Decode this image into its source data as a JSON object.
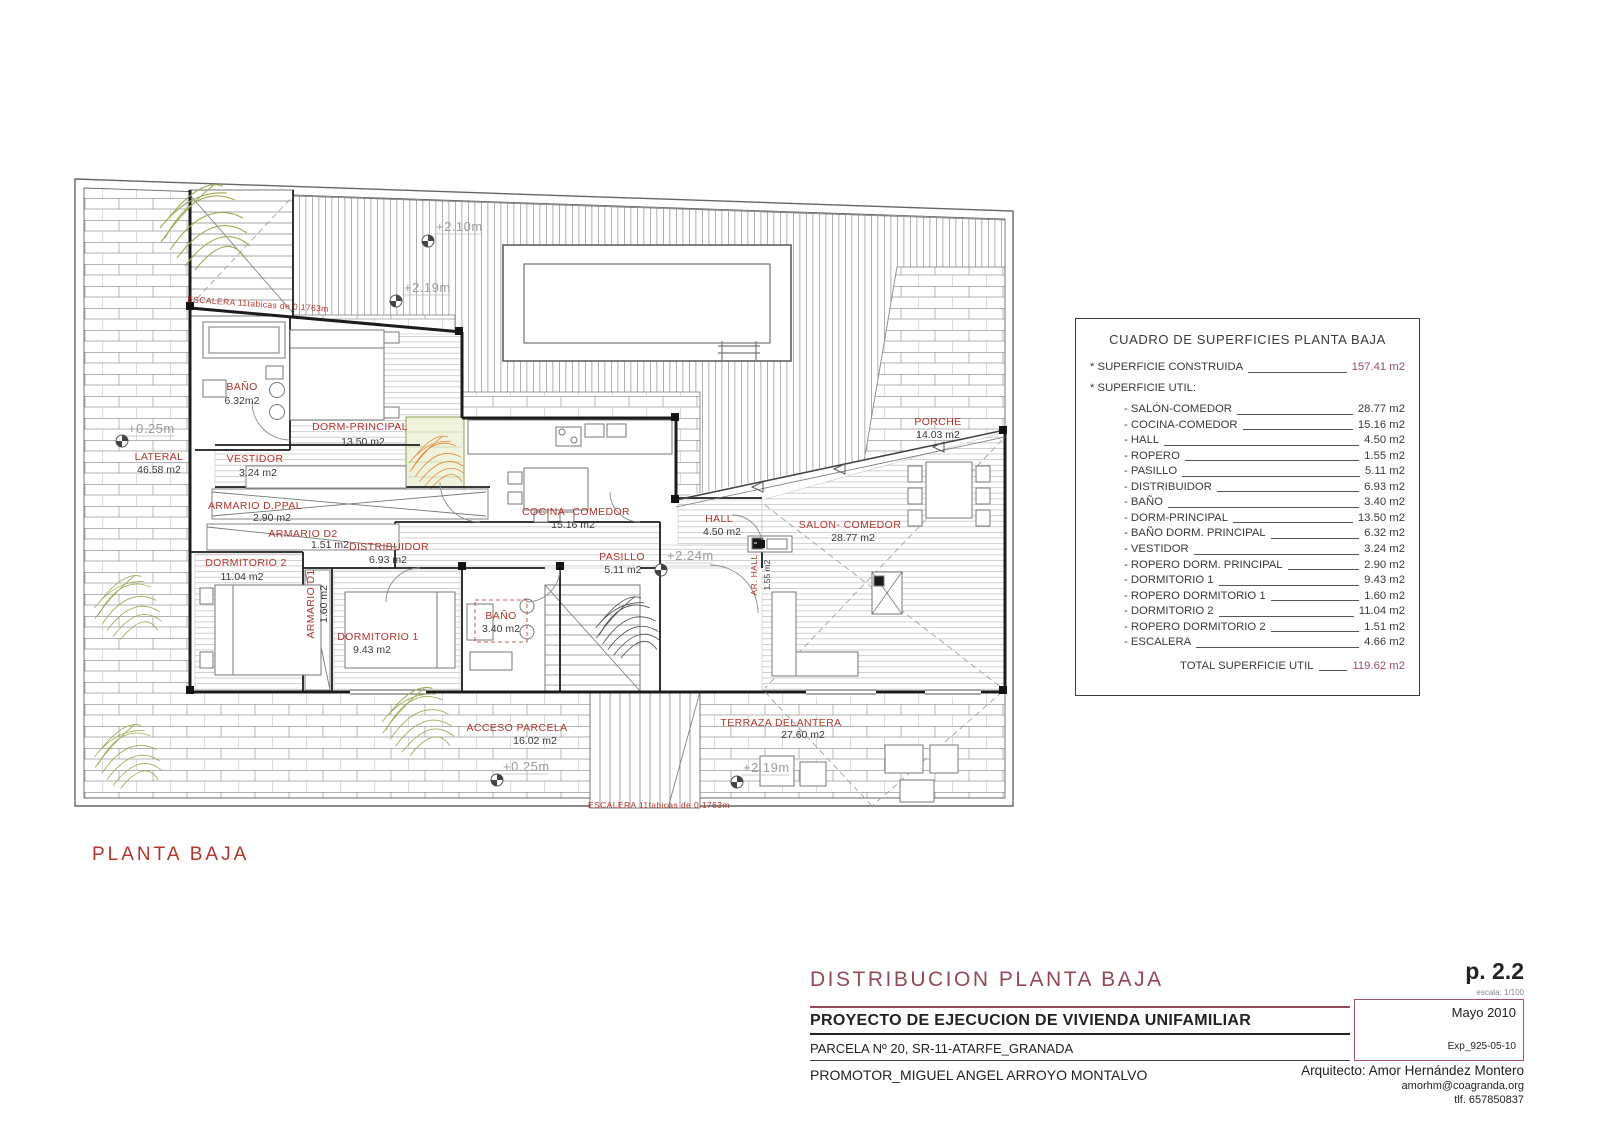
{
  "colors": {
    "label_red": "#b5342c",
    "title_maroon": "#934a56",
    "annotation_gray": "#9c9c9c",
    "line_dark": "#3a3a3a"
  },
  "plan": {
    "caption": "PLANTA BAJA",
    "stairs_note_top": "ESCALERA 11tabicas de 0.1763m",
    "stairs_note_bottom": "ESCALERA 11tabicas de 0.1763m",
    "levels": [
      "+2.10m",
      "+2.19m",
      "+0.25m",
      "+2.24m",
      "+0.25m",
      "+2.19m"
    ],
    "rooms": [
      {
        "name": "BAÑO",
        "area": "6.32m2"
      },
      {
        "name": "DORM-PRINCIPAL",
        "area": "13.50 m2"
      },
      {
        "name": "VESTIDOR",
        "area": "3.24 m2"
      },
      {
        "name": "ARMARIO D.PPAL",
        "area": "2.90 m2"
      },
      {
        "name": "ARMARIO D2",
        "area": "1.51 m2"
      },
      {
        "name": "DORMITORIO 2",
        "area": "11.04 m2"
      },
      {
        "name": "DISTRIBUIDOR",
        "area": "6.93 m2"
      },
      {
        "name": "ARMARIO D1",
        "area": "1.60 m2"
      },
      {
        "name": "DORMITORIO 1",
        "area": "9.43 m2"
      },
      {
        "name": "BAÑO",
        "area": "3.40 m2"
      },
      {
        "name": "COCINA- COMEDOR",
        "area": "15.16 m2"
      },
      {
        "name": "HALL",
        "area": "4.50 m2"
      },
      {
        "name": "PASILLO",
        "area": "5.11 m2"
      },
      {
        "name": "AR. HALL",
        "area": "1.55 m2"
      },
      {
        "name": "SALON- COMEDOR",
        "area": "28.77 m2"
      },
      {
        "name": "PORCHE",
        "area": "14.03 m2"
      },
      {
        "name": "LATERAL",
        "area": "46.58 m2"
      },
      {
        "name": "ACCESO PARCELA",
        "area": "16.02 m2"
      },
      {
        "name": "TERRAZA DELANTERA",
        "area": "27.60 m2"
      }
    ]
  },
  "table": {
    "title": "CUADRO DE SUPERFICIES PLANTA BAJA",
    "construida_label": "* SUPERFICIE CONSTRUIDA",
    "construida_value": "157.41 m2",
    "util_label": "* SUPERFICIE UTIL:",
    "rows": [
      {
        "label": "- SALÓN-COMEDOR",
        "value": "28.77 m2"
      },
      {
        "label": "- COCINA-COMEDOR",
        "value": "15.16 m2"
      },
      {
        "label": "- HALL",
        "value": "4.50 m2"
      },
      {
        "label": "- ROPERO",
        "value": "1.55 m2"
      },
      {
        "label": "- PASILLO",
        "value": "5.11 m2"
      },
      {
        "label": "- DISTRIBUIDOR",
        "value": "6.93 m2"
      },
      {
        "label": "- BAÑO",
        "value": "3.40 m2"
      },
      {
        "label": "- DORM-PRINCIPAL",
        "value": "13.50 m2"
      },
      {
        "label": "- BAÑO DORM. PRINCIPAL",
        "value": "6.32 m2"
      },
      {
        "label": "- VESTIDOR",
        "value": "3.24 m2"
      },
      {
        "label": "- ROPERO DORM. PRINCIPAL",
        "value": "2.90 m2"
      },
      {
        "label": "- DORMITORIO 1",
        "value": "9.43 m2"
      },
      {
        "label": "- ROPERO DORMITORIO 1",
        "value": "1.60 m2"
      },
      {
        "label": "- DORMITORIO 2",
        "value": "11.04 m2"
      },
      {
        "label": "- ROPERO DORMITORIO 2",
        "value": "1.51 m2"
      },
      {
        "label": "- ESCALERA",
        "value": "4.66 m2"
      }
    ],
    "total_label": "TOTAL SUPERFICIE UTIL",
    "total_value": "119.62 m2"
  },
  "titleblock": {
    "title": "DISTRIBUCION PLANTA BAJA",
    "page_number": "p. 2.2",
    "scale": "escala: 1/100",
    "project": "PROYECTO  DE EJECUCION DE VIVIENDA UNIFAMILIAR",
    "date": "Mayo 2010",
    "parcel": "PARCELA Nº 20, SR-11-ATARFE_GRANADA",
    "exp": "Exp_925-05-10",
    "promoter": "PROMOTOR_MIGUEL ANGEL ARROYO MONTALVO",
    "architect": "Arquitecto: Amor Hernández Montero",
    "email": "amorhm@coagranda.org",
    "phone": "tlf. 657850837"
  }
}
